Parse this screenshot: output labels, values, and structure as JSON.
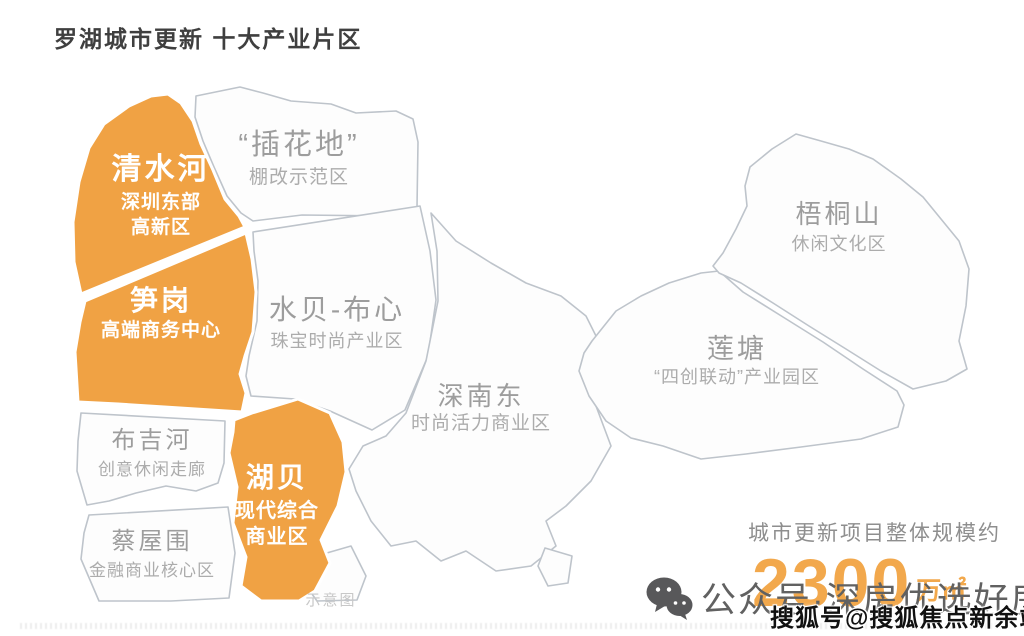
{
  "title": "罗湖城市更新 十大产业片区",
  "map": {
    "regions": [
      {
        "id": "qingshuihe",
        "name": "清水河",
        "sub1": "深圳东部",
        "sub2": "高新区",
        "accent": "orange"
      },
      {
        "id": "chahuadi",
        "name": "“插花地”",
        "sub1": "棚改示范区",
        "accent": "plain"
      },
      {
        "id": "sungang",
        "name": "笋岗",
        "sub1": "高端商务中心",
        "accent": "orange"
      },
      {
        "id": "shuibei",
        "name": "水贝-布心",
        "sub1": "珠宝时尚产业区",
        "accent": "plain"
      },
      {
        "id": "wutongshan",
        "name": "梧桐山",
        "sub1": "休闲文化区",
        "accent": "plain"
      },
      {
        "id": "liantang",
        "name": "莲塘",
        "sub1": "“四创联动”产业园区",
        "accent": "plain"
      },
      {
        "id": "shennandong",
        "name": "深南东",
        "sub1": "时尚活力商业区",
        "accent": "plain"
      },
      {
        "id": "bujihe",
        "name": "布吉河",
        "sub1": "创意休闲走廊",
        "accent": "plain"
      },
      {
        "id": "hubei",
        "name": "湖贝",
        "sub1": "现代综合",
        "sub2": "商业区",
        "accent": "orange"
      },
      {
        "id": "caiwuwei",
        "name": "蔡屋围",
        "sub1": "金融商业核心区",
        "accent": "plain"
      }
    ],
    "note": "示意图"
  },
  "stats": {
    "caption": "城市更新项目整体规模约",
    "value": "2300",
    "unit": "万㎡"
  },
  "watermarks": {
    "wechat_label": "公众号·深房优选好房",
    "sohu_label": "搜狐号@搜狐焦点新余站"
  },
  "colors": {
    "orange": "#F0A244",
    "orange_light": "#F2A84C",
    "region_stroke": "#BEC4CB",
    "region_fill": "#FDFDFD",
    "title_text": "#3F3F3F",
    "muted_text": "#9D9D9D",
    "muted_subtext": "#ACACAC",
    "stats_text": "#8E8E8E",
    "watermark_gray": "#616161",
    "sohu_black": "#111111"
  }
}
